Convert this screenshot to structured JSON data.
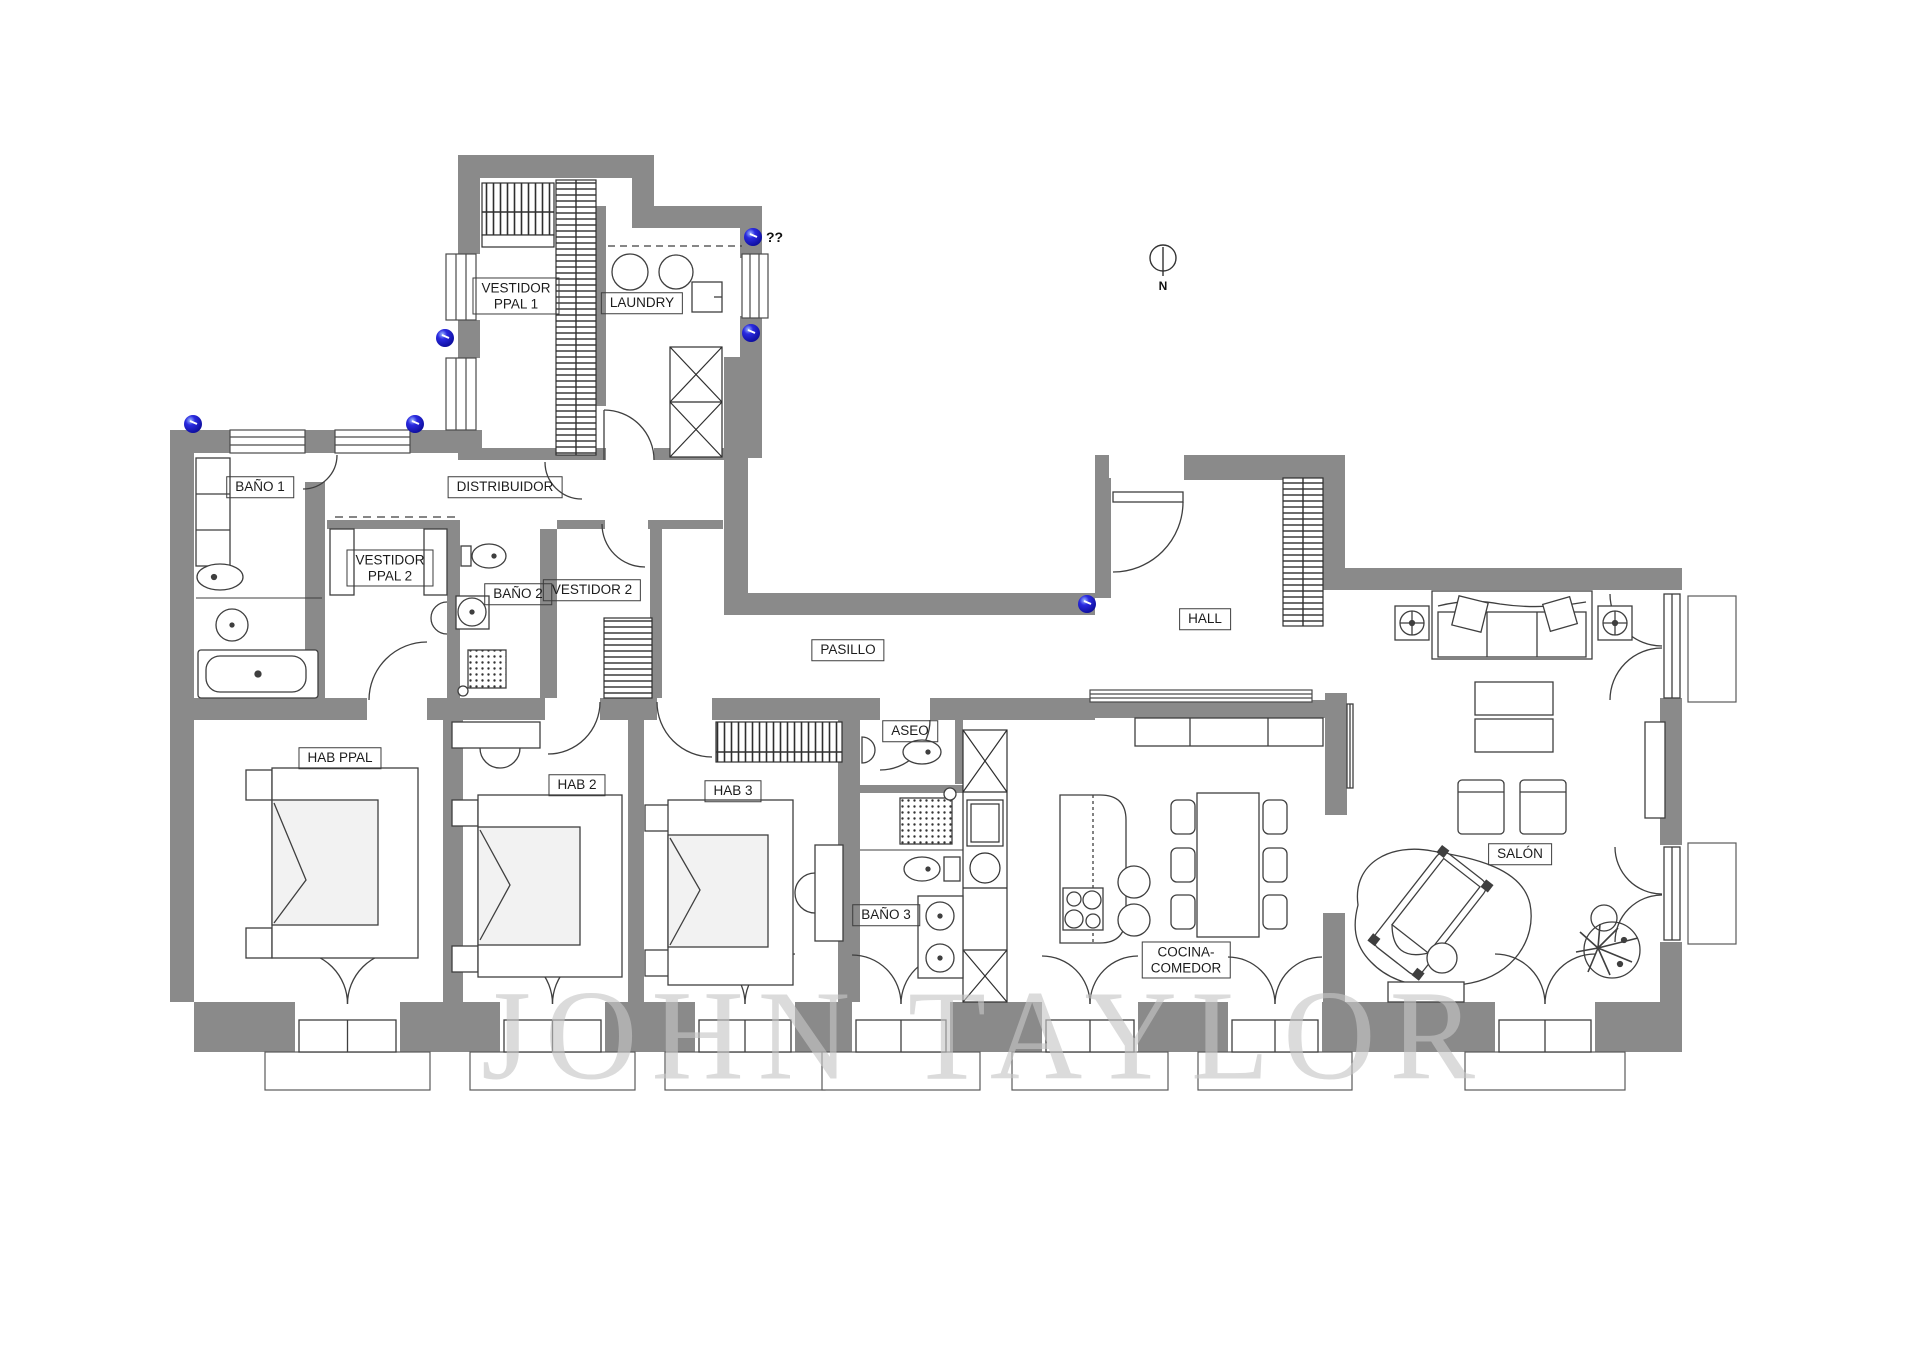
{
  "watermark": "JOHN TAYLOR",
  "annotations": {
    "unknown_marker": "??",
    "north": "N"
  },
  "colors": {
    "wall_gray": "#8a8a8a",
    "line_dark": "#3f3f3f",
    "marker_blue": "#1717cf",
    "watermark_gray": "#c6c6c6"
  },
  "rooms": {
    "vestidor_ppal_1": {
      "line1": "VESTIDOR",
      "line2": "PPAL 1"
    },
    "laundry": {
      "label": "LAUNDRY"
    },
    "bano_1": {
      "label": "BAÑO 1"
    },
    "distribuidor": {
      "label": "DISTRIBUIDOR"
    },
    "vestidor_ppal_2": {
      "line1": "VESTIDOR",
      "line2": "PPAL 2"
    },
    "bano_2": {
      "label": "BAÑO 2"
    },
    "vestidor_2": {
      "label": "VESTIDOR 2"
    },
    "pasillo": {
      "label": "PASILLO"
    },
    "hall": {
      "label": "HALL"
    },
    "aseo": {
      "label": "ASEO"
    },
    "hab_ppal": {
      "label": "HAB PPAL"
    },
    "hab_2": {
      "label": "HAB 2"
    },
    "hab_3": {
      "label": "HAB 3"
    },
    "bano_3": {
      "label": "BAÑO 3"
    },
    "cocina_comedor": {
      "line1": "COCINA-",
      "line2": "COMEDOR"
    },
    "salon": {
      "label": "SALÓN"
    }
  }
}
